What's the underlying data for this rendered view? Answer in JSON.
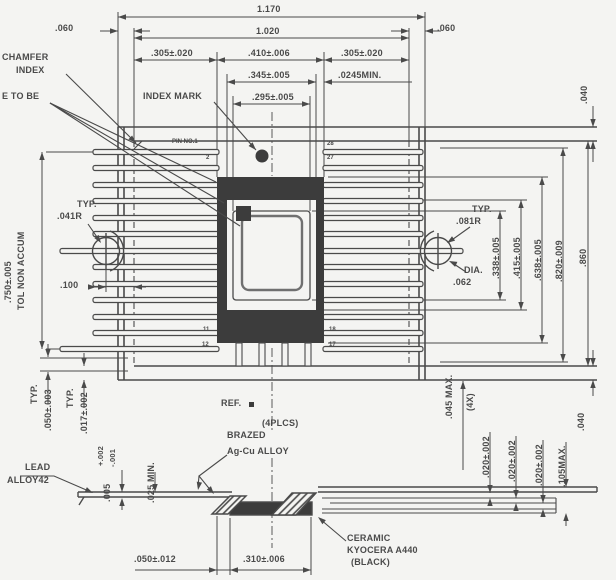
{
  "drawing": {
    "top_dims": {
      "overall": "1.170",
      "body": "1.020",
      "edge_left": ".060",
      "edge_right": ".060",
      "seg_left": ".305±.020",
      "seg_mid": ".410±.006",
      "seg_right": ".305±.020",
      "cavity_outer_w": ".345±.005",
      "min_clearance": ".0245MIN.",
      "cavity_inner_w": ".295±.005"
    },
    "left_dims": {
      "lead_span": ".750±.005",
      "tol_note": "TOL NON ACCUM",
      "typ": "TYP.",
      "radius": ".041R",
      "offset": ".100"
    },
    "right_dims": {
      "gap_top": ".040",
      "overall_h": ".860",
      "body_h": ".820±.009",
      "seal_h": ".638±.005",
      "cavity_outer_h": ".415±.005",
      "cavity_inner_h": ".338±.005",
      "typ": "TYP.",
      "radius": ".081R",
      "dia_label": "DIA.",
      "dia": ".062"
    },
    "labels": {
      "chamfer1": "CHAMFER",
      "chamfer2": "INDEX",
      "note_fragment": "E TO BE",
      "index_mark": "INDEX MARK",
      "pin_no1": "PIN NO.1",
      "ref": "REF.",
      "places": "(4PLCS)",
      "brazed": "BRAZED",
      "braze_alloy": "Ag-Cu ALLOY",
      "lead1": "LEAD",
      "lead2": "ALLOY42",
      "ceramic1": "CERAMIC",
      "ceramic2": "KYOCERA A440",
      "ceramic3": "(BLACK)"
    },
    "pins": {
      "p2": "2",
      "p28": "28",
      "p27": "27",
      "p18": "18",
      "p17": "17",
      "p11": "11",
      "p12": "12"
    },
    "bottom_dims": {
      "pitch_typ_label": "TYP.",
      "pitch": ".050±.003",
      "width_typ_label": "TYP.",
      "width": ".017±.002",
      "thickness": ".005",
      "thickness_plus": "+.002",
      "thickness_minus": "-.001",
      "standoff": ".025 MIN.",
      "braze": ".050±.012",
      "pad": ".310±.006",
      "tip": ".045 MAX.",
      "tip_qty": "(4X)",
      "layer1": ".020±.002",
      "layer2": ".020±.002",
      "layer3": ".020±.002",
      "stack_max": ".105MAX.",
      "gap": ".040"
    },
    "colors": {
      "ink": "#4a4a4a",
      "fill_dark": "#3c3c3c",
      "background": "#f4f4f2"
    }
  }
}
